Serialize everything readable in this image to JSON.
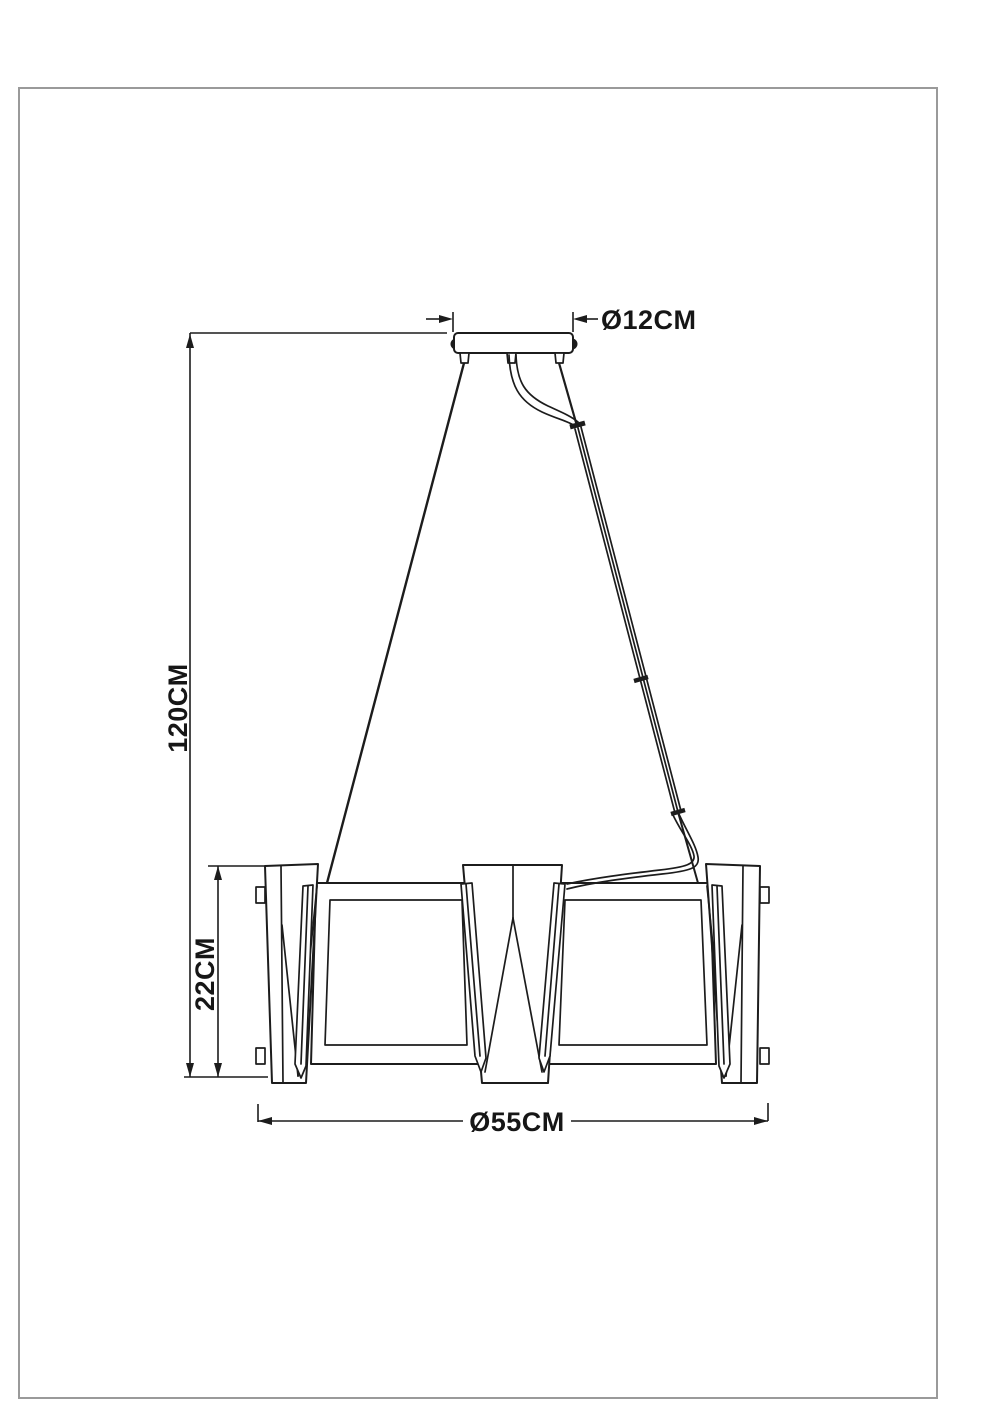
{
  "page": {
    "background": "#ffffff",
    "frame_border_color": "#9a9a9a",
    "ink_color": "#1c1c1c"
  },
  "drawing": {
    "type": "technical-dimension-drawing",
    "subject": "pendant chandelier side elevation with ceiling canopy, suspension cables and six-light frame body",
    "labels": {
      "canopy_diameter": "Ø12CM",
      "suspension_height": "120CM",
      "body_height": "22CM",
      "body_diameter": "Ø55CM"
    }
  }
}
